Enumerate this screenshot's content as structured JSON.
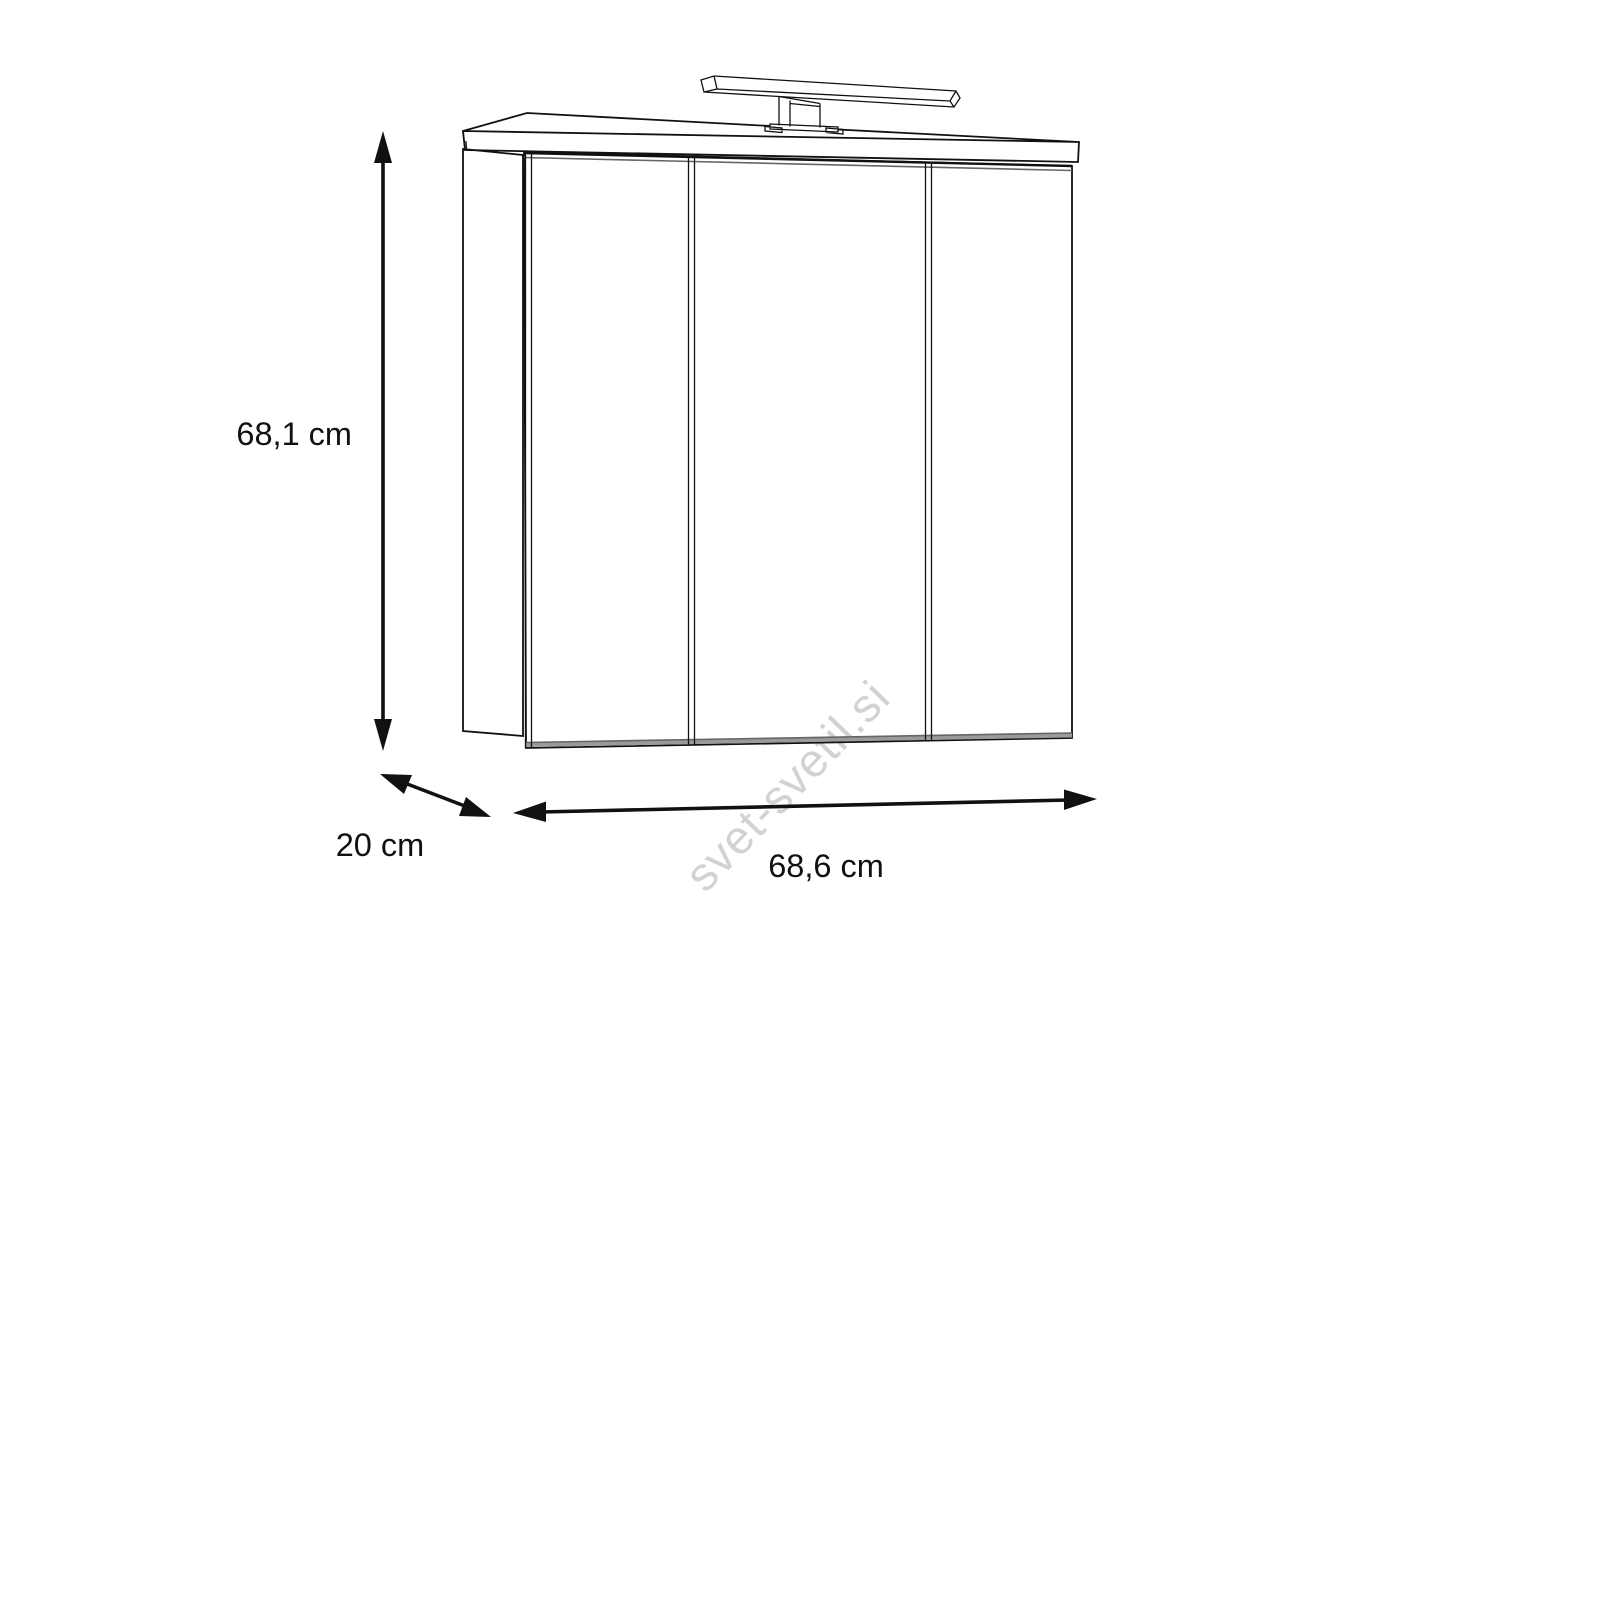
{
  "figure": {
    "description": "Technical dimension line drawing of a three-door mirror bathroom cabinet with an overhead light bar",
    "dimensions": {
      "height": {
        "label": "68,1 cm",
        "value_cm": 68.1
      },
      "depth": {
        "label": "20 cm",
        "value_cm": 20
      },
      "width": {
        "label": "68,6 cm",
        "value_cm": 68.6
      }
    }
  },
  "watermark": {
    "text": "svet-svetil.si"
  },
  "colors": {
    "background": "#ffffff",
    "line": "#111111",
    "shade": "#9a9a9a",
    "watermark": "#d2d2d2"
  }
}
